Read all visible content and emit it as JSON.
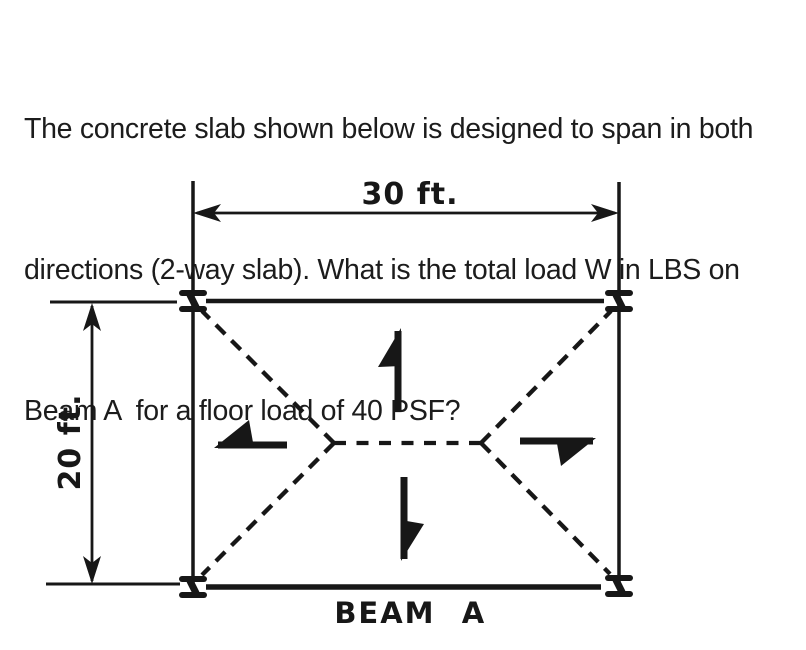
{
  "question": {
    "lines": [
      "The concrete slab shown below is designed to span in both",
      "directions (2-way slab). What is the total load W in LBS on",
      "Beam A  for a floor load of 40 PSF?"
    ]
  },
  "diagram": {
    "width_label": "30 ft.",
    "height_label": "20 ft.",
    "beam_word": "BEAM",
    "beam_letter": "A",
    "ink_color": "#171717",
    "background_color": "#ffffff"
  }
}
